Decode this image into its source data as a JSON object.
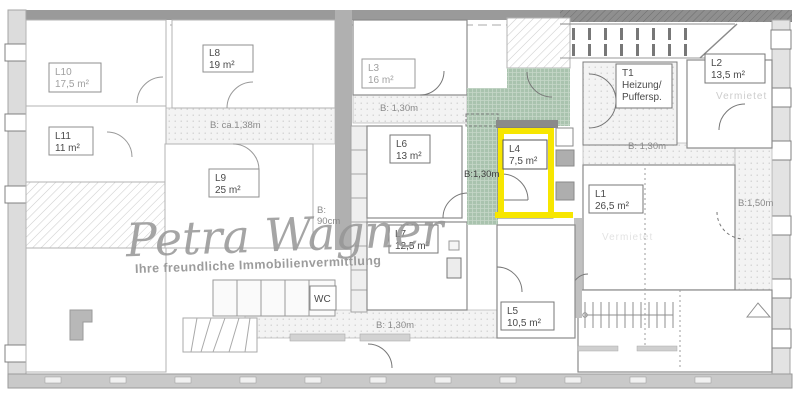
{
  "watermark": {
    "brand": "Petra Wagner",
    "tagline": "Ihre freundliche Immobilienvermittlung"
  },
  "rooms": {
    "l10": {
      "id": "L10",
      "area": "17,5 m²"
    },
    "l8": {
      "id": "L8",
      "area": "19 m²"
    },
    "l11": {
      "id": "L11",
      "area": "11 m²"
    },
    "l9": {
      "id": "L9",
      "area": "25 m²"
    },
    "l3": {
      "id": "L3",
      "area": "16 m²"
    },
    "l6": {
      "id": "L6",
      "area": "13 m²"
    },
    "l7": {
      "id": "L7",
      "area": "12,5 m²"
    },
    "l4": {
      "id": "L4",
      "area": "7,5 m²",
      "highlighted": true
    },
    "l5": {
      "id": "L5",
      "area": "10,5 m²"
    },
    "l1": {
      "id": "L1",
      "area": "26,5 m²"
    },
    "l2": {
      "id": "L2",
      "area": "13,5 m²"
    },
    "t1": {
      "id": "T1",
      "line1": "Heizung/",
      "line2": "Puffersp."
    },
    "wc": {
      "id": "WC"
    }
  },
  "dimensions": {
    "corridor_left": "B: ca.1,38m",
    "corridor_mid": "B: 1,30m",
    "corridor_green": "B:1,30m",
    "corridor_right": "B: 1,30m",
    "corridor_bottom": "B: 1,30m",
    "corridor_right_v": "B:1,50m",
    "shaft_line1": "B:",
    "shaft_line2": "90cm"
  },
  "status": {
    "l2_status": "Vermietet",
    "l1_status": "Vermietet"
  },
  "colors": {
    "highlight_yellow": "#f7e600",
    "corridor_green": "#a9c3ae",
    "wall_gray": "#9a9a9a",
    "watermark_gray": "#969696"
  }
}
